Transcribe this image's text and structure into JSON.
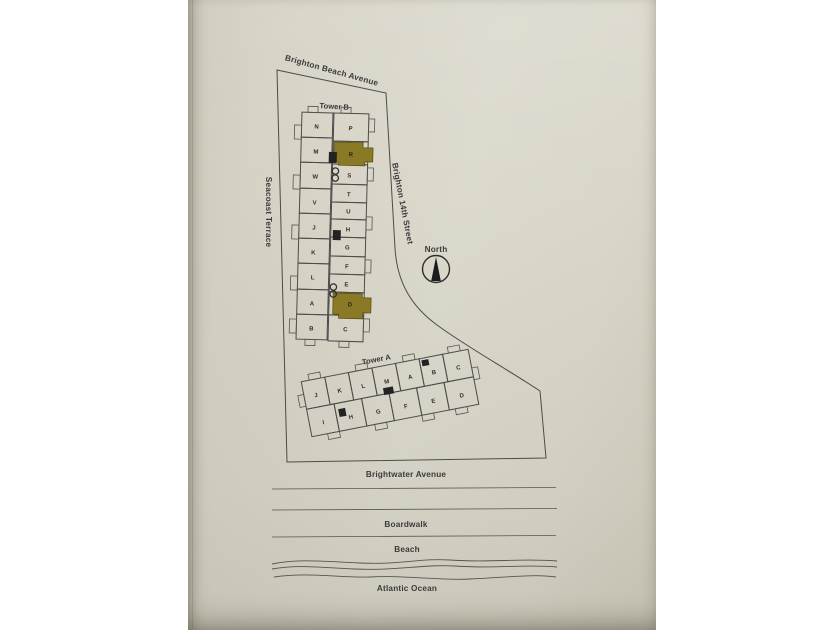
{
  "scene": {
    "kind": "photo of a paper condominium site plan",
    "paper_color": "#d8d4c7",
    "page_background": "#ffffff",
    "ink_color": "#3b3b3b",
    "highlight_color": "#8a7a28"
  },
  "streets": {
    "top": "Brighton Beach Avenue",
    "right": "Brighton 14th Street",
    "left": "Seacoast Terrace",
    "bottom": "Brightwater Avenue"
  },
  "compass": {
    "label": "North"
  },
  "tower_b": {
    "label": "Tower B",
    "left_units": [
      "N",
      "M",
      "W",
      "V",
      "J",
      "K",
      "L",
      "A",
      "B"
    ],
    "right_units": [
      "P",
      "R",
      "S",
      "T",
      "U",
      "H",
      "G",
      "F",
      "E",
      "D",
      "C"
    ],
    "highlighted_units": [
      "R",
      "D"
    ]
  },
  "tower_a": {
    "label": "Tower A",
    "top_units": [
      "J",
      "K",
      "L",
      "M",
      "A",
      "B",
      "C"
    ],
    "bottom_units": [
      "I",
      "H",
      "G",
      "F",
      "E",
      "D"
    ]
  },
  "waterfront": {
    "boardwalk_label": "Boardwalk",
    "beach_label": "Beach",
    "ocean_label": "Atlantic Ocean"
  }
}
